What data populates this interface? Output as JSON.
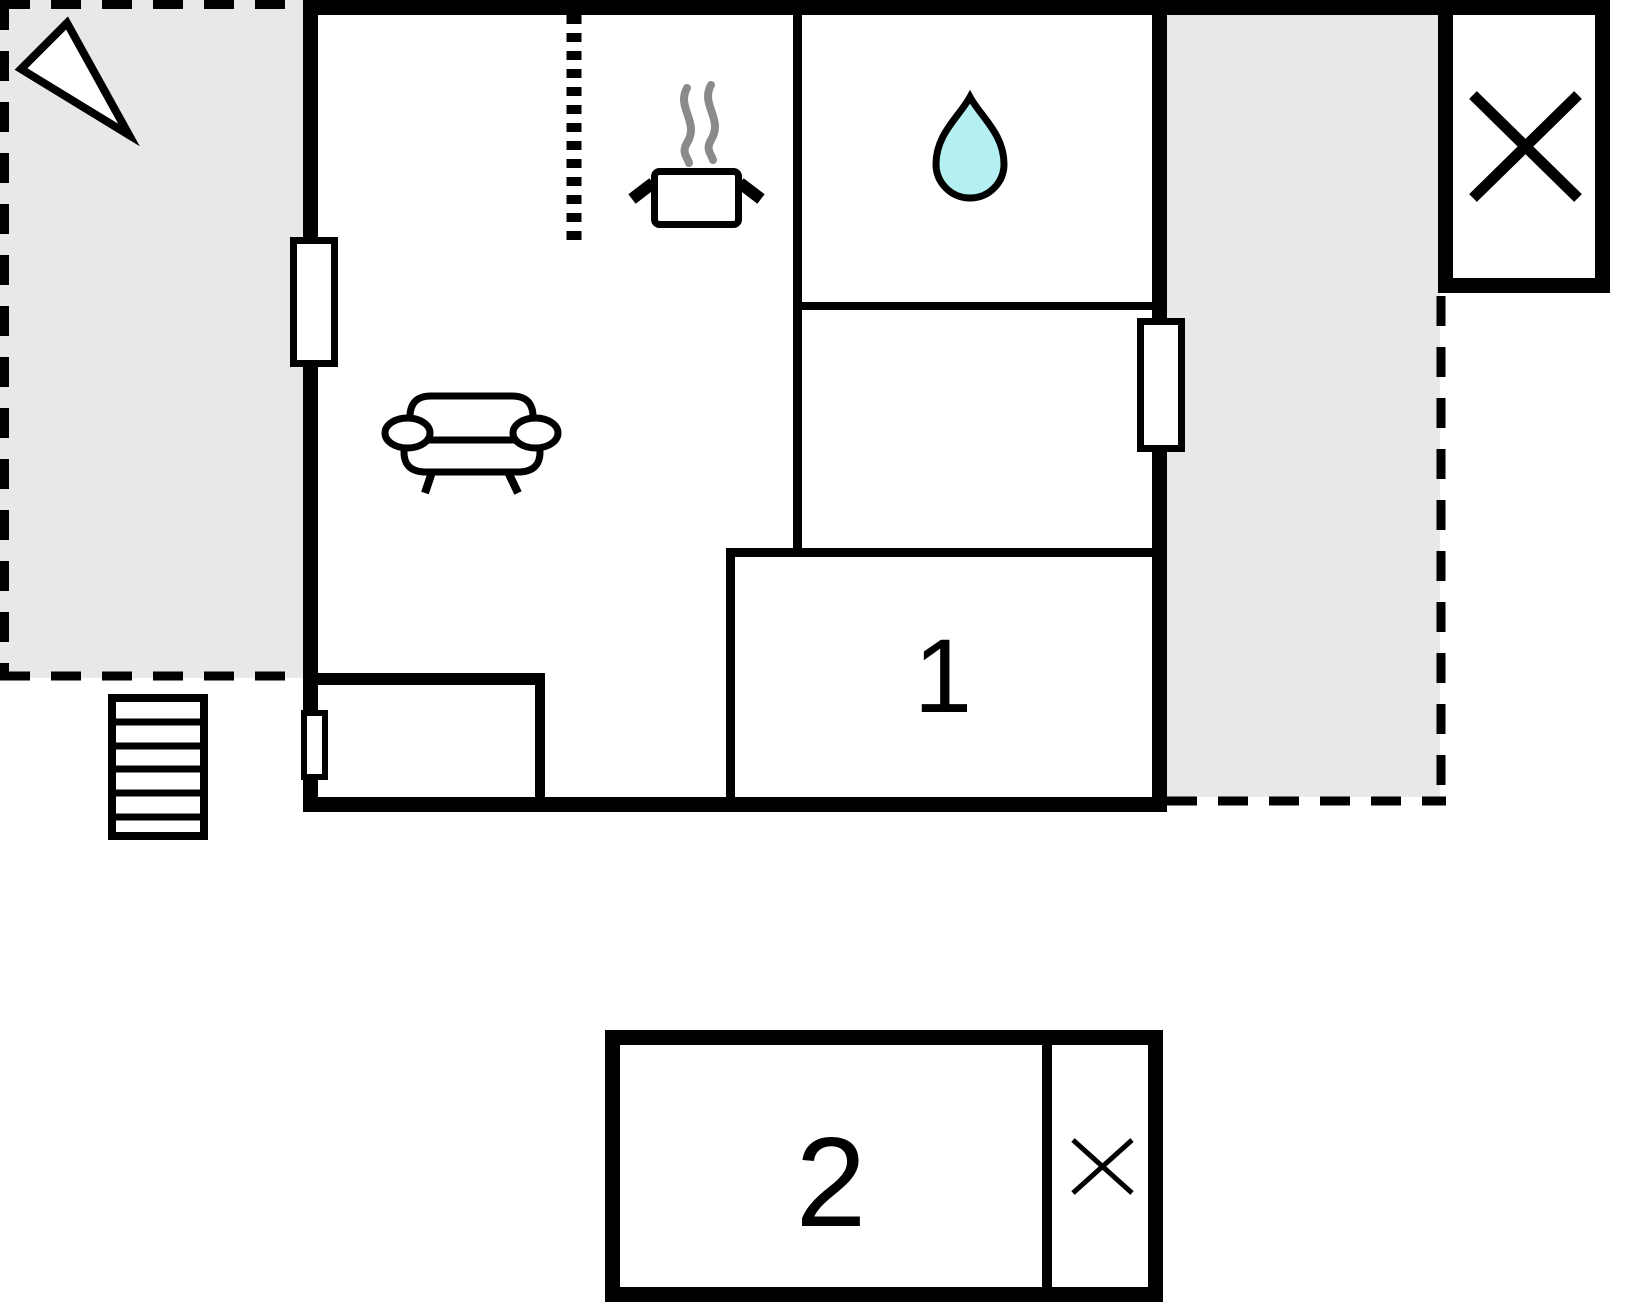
{
  "floorplan": {
    "rooms": {
      "room1": {
        "label": "1"
      },
      "room2": {
        "label": "2"
      }
    },
    "colors": {
      "wall": "#000000",
      "terrace_fill": "#e8e8e8",
      "water_drop_fill": "#b4f0f2",
      "steam": "#8a8a8a",
      "background": "#ffffff"
    },
    "icons": {
      "compass": "compass-arrow-icon",
      "pot": "cooking-pot-icon",
      "steam": "steam-icon",
      "water_drop": "water-drop-icon",
      "sofa": "sofa-icon",
      "stairs": "stairs-icon",
      "window_x_large": "window-x-icon",
      "window_x_small": "window-x-icon"
    }
  }
}
